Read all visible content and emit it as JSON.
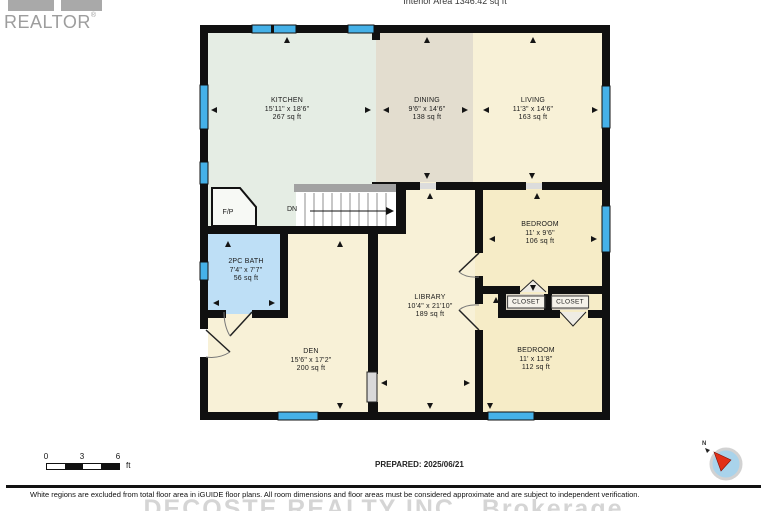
{
  "header": {
    "interior_area": "Interior Area 1346.42 sq ft",
    "logo_text": "REALTOR",
    "logo_reg": "®"
  },
  "rooms": [
    {
      "name": "KITCHEN",
      "dims": "15'11\" x 18'6\"",
      "area": "267 sq ft"
    },
    {
      "name": "DINING",
      "dims": "9'6\" x 14'6\"",
      "area": "138 sq ft"
    },
    {
      "name": "LIVING",
      "dims": "11'3\" x 14'6\"",
      "area": "163 sq ft"
    },
    {
      "name": "BEDROOM",
      "dims": "11' x 9'6\"",
      "area": "106 sq ft"
    },
    {
      "name": "2PC BATH",
      "dims": "7'4\" x 7'7\"",
      "area": "56 sq ft"
    },
    {
      "name": "LIBRARY",
      "dims": "10'4\" x 21'10\"",
      "area": "189 sq ft"
    },
    {
      "name": "DEN",
      "dims": "15'6\" x 17'2\"",
      "area": "200 sq ft"
    },
    {
      "name": "BEDROOM",
      "dims": "11' x 11'8\"",
      "area": "112 sq ft"
    }
  ],
  "plan": {
    "closet1": "CLOSET",
    "closet2": "CLOSET",
    "fireplace": "F/P",
    "stairs_down": "DN"
  },
  "scale_bar": {
    "ticks": [
      "0",
      "3",
      "6"
    ],
    "unit": "ft"
  },
  "compass": {
    "north": "N"
  },
  "footer": {
    "prepared": "PREPARED: 2025/06/21",
    "disclaimer": "White regions are excluded from total floor area in iGUIDE floor plans. All room dimensions and floor areas must be considered approximate and are subject to independent verification.",
    "watermark": "DECOSTE REALTY INC., Brokerage"
  },
  "colors": {
    "kitchen": "#e5ede4",
    "dining": "#e3ddcf",
    "living": "#f8f1d7",
    "bedroom": "#f6ecc7",
    "bath": "#bedff6",
    "window": "#45b1e8",
    "wall": "#101010",
    "closet_fill": "#d9d3c5",
    "stair_header": "#a2a2a2",
    "watermark_gray": "#d5d5d5",
    "compass_red": "#e23018",
    "compass_blue": "#a9d3eb",
    "logo_gray": "#9d9d9d"
  }
}
